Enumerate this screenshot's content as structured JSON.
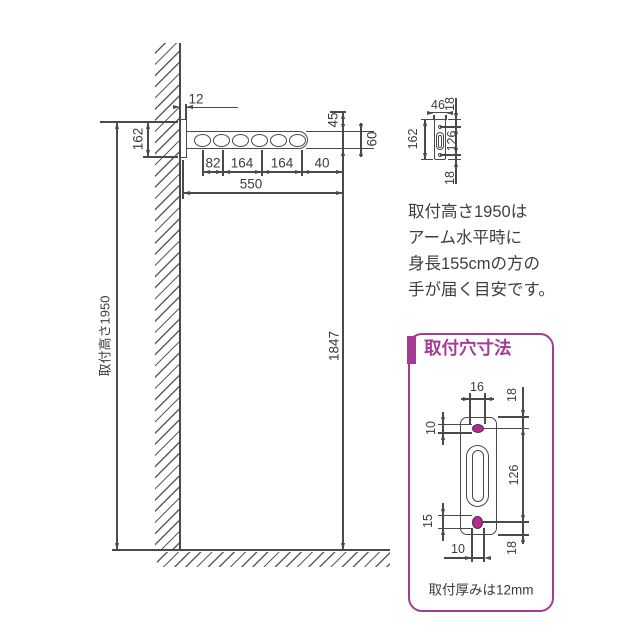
{
  "main_view": {
    "wall_thickness": "12",
    "plate_height": "162",
    "pole_drop": "45",
    "arm_end_height": "60",
    "segments": [
      "82",
      "164",
      "164",
      "40"
    ],
    "arm_length": "550",
    "clearance": "1847",
    "height_label": "取付高さ1950"
  },
  "side_view": {
    "width": "46",
    "edge_top": "18",
    "height": "162",
    "hole_pitch": "126",
    "edge_bottom": "18"
  },
  "note_lines": [
    "取付高さ1950は",
    "アーム水平時に",
    "身長155cmの方の",
    "手が届く目安です。"
  ],
  "hole_box": {
    "title": "取付穴寸法",
    "top_hole_width": "16",
    "edge_top": "18",
    "top_hole_height": "10",
    "hole_pitch": "126",
    "bottom_hole_height": "15",
    "bottom_hole_width": "10",
    "edge_bottom": "18",
    "note": "取付厚みは12mm"
  },
  "colors": {
    "accent": "#a63b97",
    "hole_fill": "#b8288f",
    "line": "#4a4a4a"
  }
}
